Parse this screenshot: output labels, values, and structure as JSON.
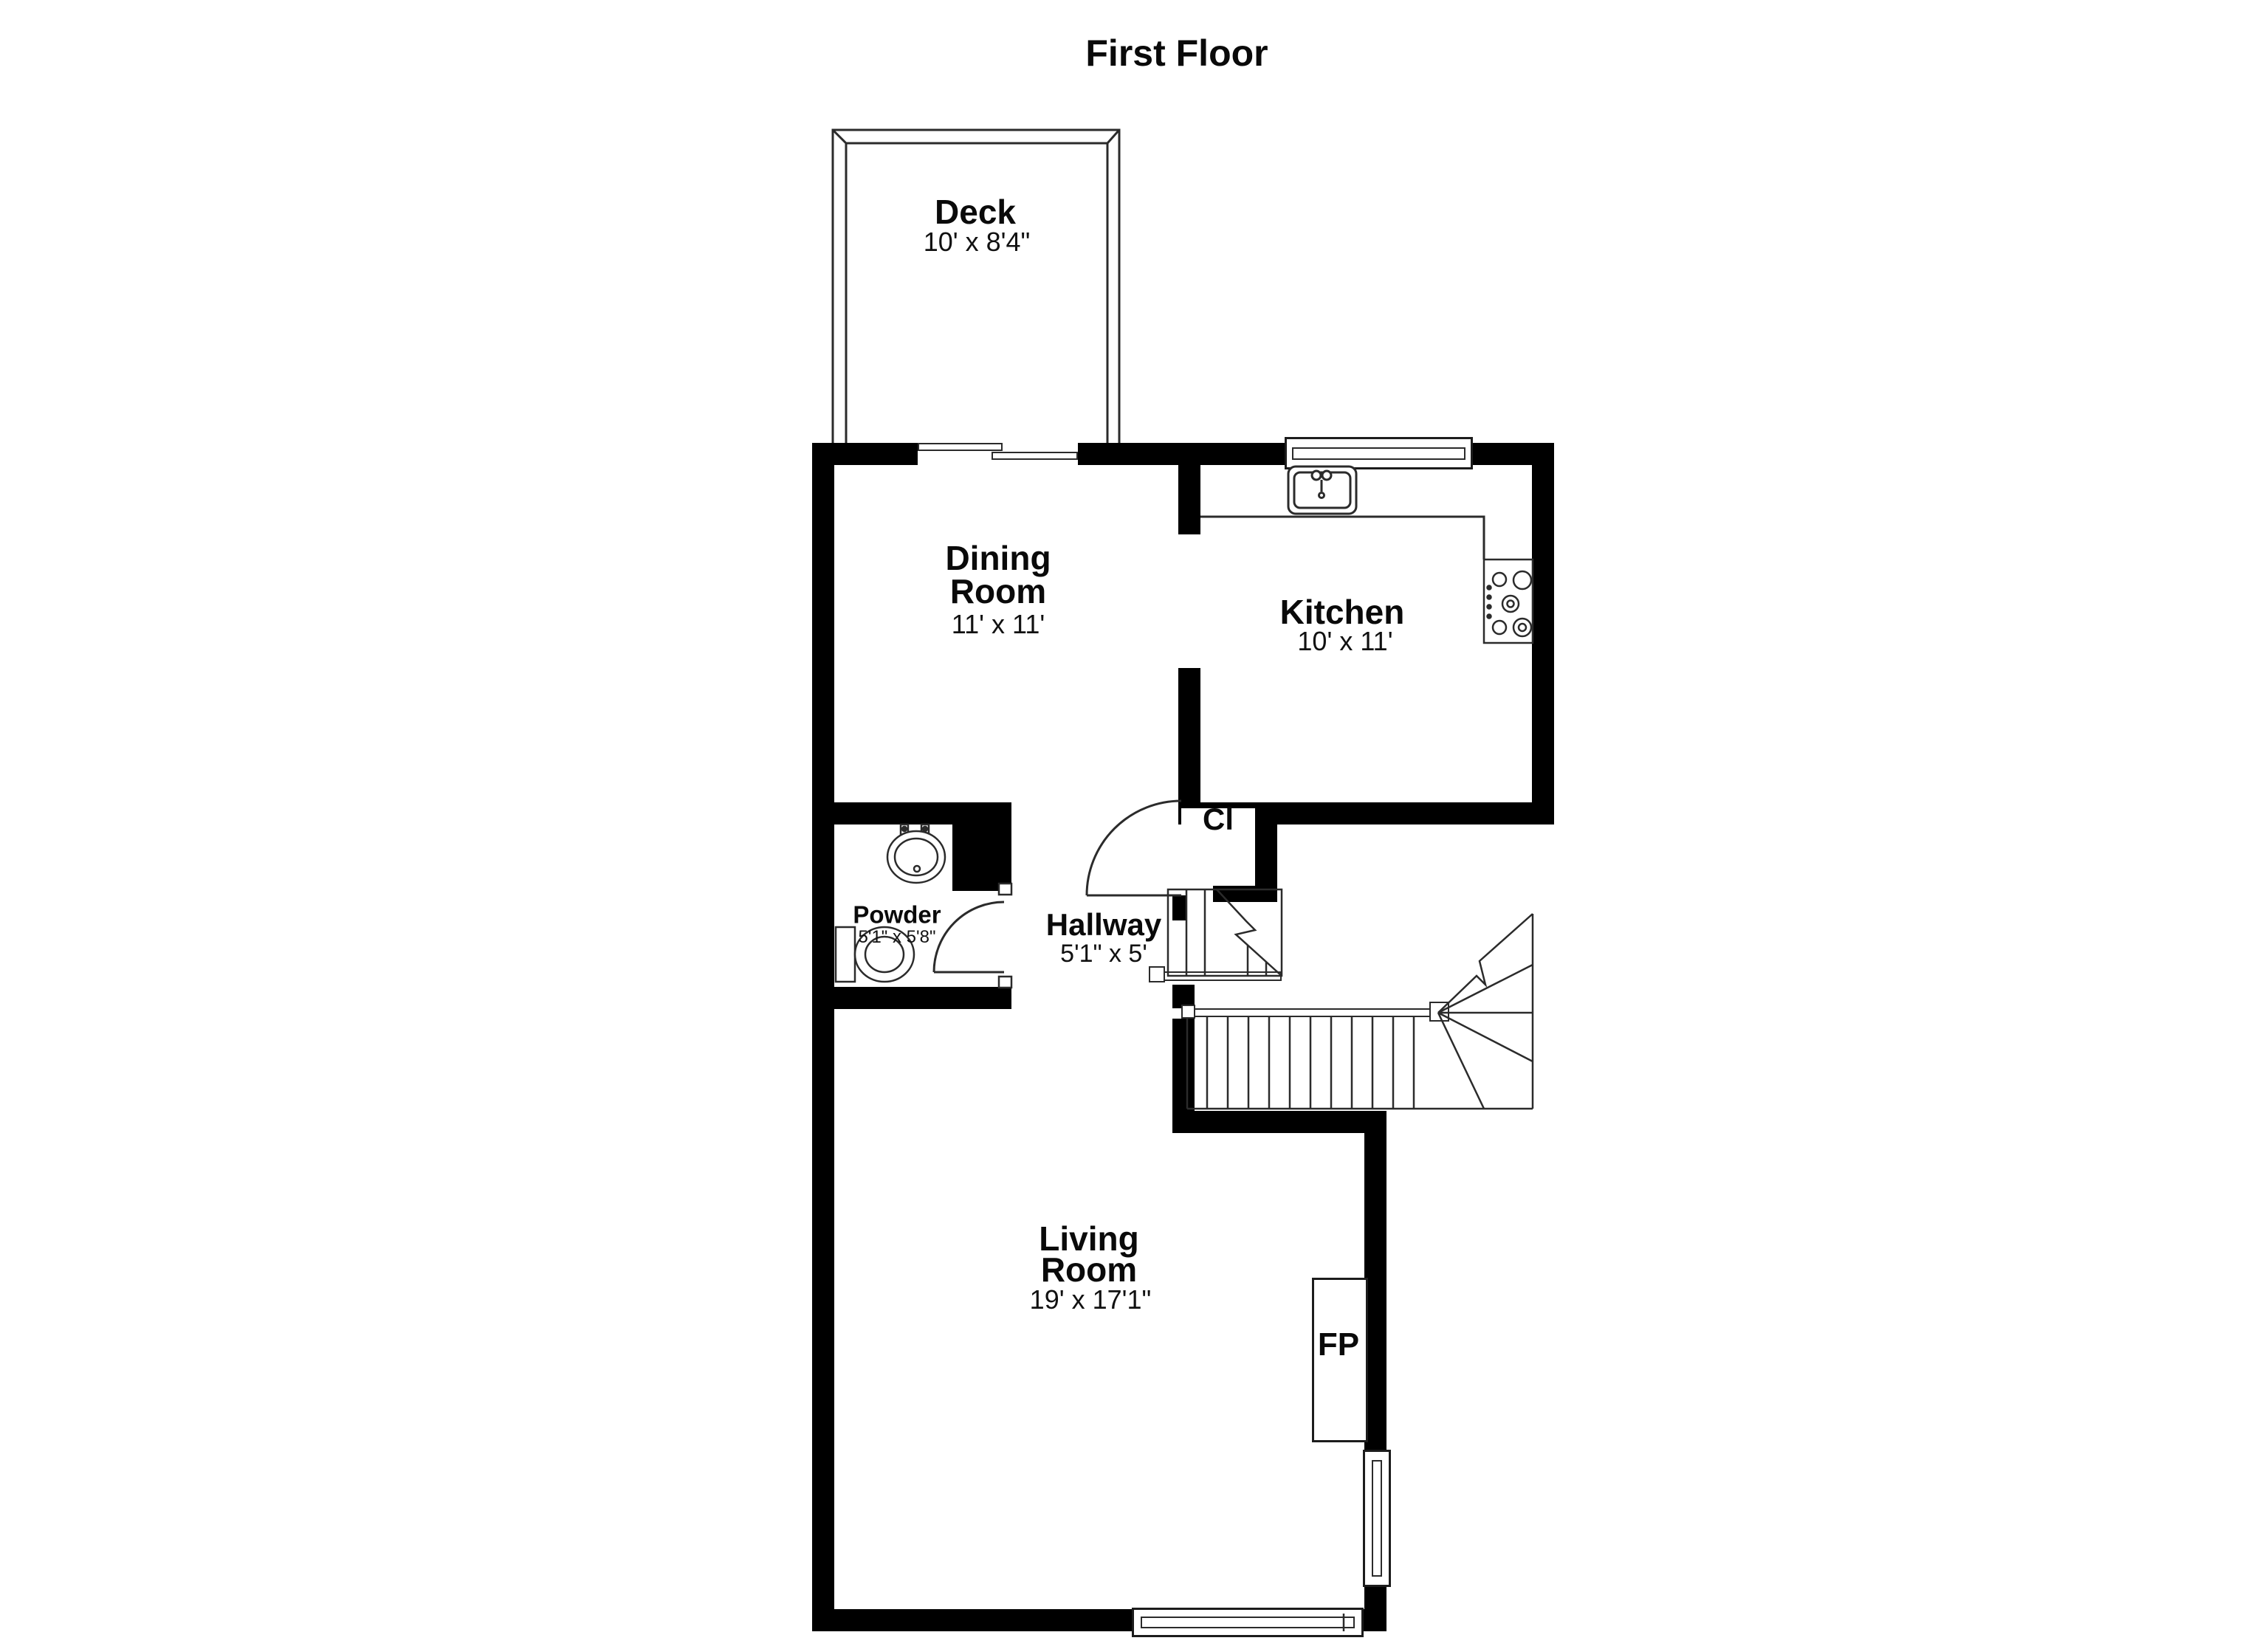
{
  "title": "First Floor",
  "colors": {
    "wall": "#000000",
    "background": "#ffffff",
    "line": "#2b2b2b"
  },
  "rooms": [
    {
      "id": "deck",
      "name": "Deck",
      "dims": "10' x 8'4\""
    },
    {
      "id": "dining-room",
      "name": "Dining",
      "name_line2": "Room",
      "dims": "11' x 11'"
    },
    {
      "id": "kitchen",
      "name": "Kitchen",
      "dims": "10' x 11'"
    },
    {
      "id": "closet",
      "name": "Cl"
    },
    {
      "id": "powder-room",
      "name": "Powder",
      "dims": "5'1\" x 5'8\""
    },
    {
      "id": "hallway",
      "name": "Hallway",
      "dims": "5'1\" x 5'"
    },
    {
      "id": "living-room",
      "name": "Living",
      "name_line2": "Room",
      "dims": "19' x 17'1\""
    },
    {
      "id": "fireplace",
      "name": "FP"
    }
  ],
  "fixtures": [
    {
      "id": "kitchen-sink",
      "icon": "kitchen-sink-icon"
    },
    {
      "id": "stove",
      "icon": "stove-cooktop-icon"
    },
    {
      "id": "bath-sink",
      "icon": "bathroom-sink-icon"
    },
    {
      "id": "toilet",
      "icon": "toilet-icon"
    },
    {
      "id": "staircase",
      "icon": "staircase-winder-icon"
    },
    {
      "id": "sliding-door",
      "icon": "sliding-door-icon"
    },
    {
      "id": "window",
      "icon": "window-icon"
    },
    {
      "id": "door-swing",
      "icon": "door-swing-icon"
    }
  ]
}
